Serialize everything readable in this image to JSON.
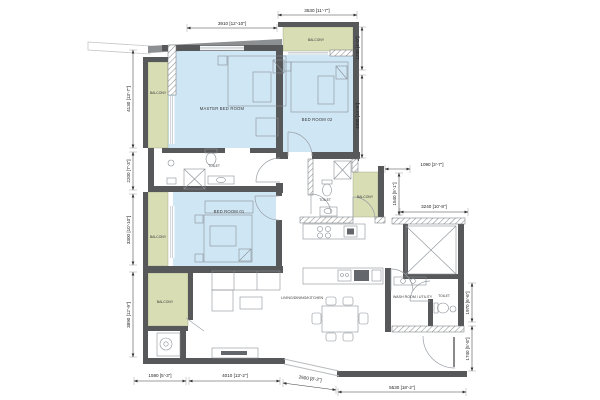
{
  "plan_type": "apartment-floor-plan",
  "labels": {
    "master_bedroom": "MASTER BED ROOM",
    "bed_room_02": "BED ROOM 02",
    "bed_room_01": "BED ROOM 01",
    "living": "LIVING/DINING/KITCHEN",
    "wash_room": "WASH ROOM / UTILITY",
    "toilet": "TOILET",
    "balcony": "BALCONY"
  },
  "dims": {
    "d3910": "3910 [12'-10\"]",
    "d3530": "3530 [11'-7\"]",
    "d1230": "1230 [4'-0\"]",
    "d4490": "4490 [14'-9\"]",
    "d1090": "1090 [3'-7\"]",
    "d1540": "1540 [5'-1\"]",
    "d3240": "3240 [10'-8\"]",
    "d1970": "1970 [6'-6\"]",
    "d1740": "1740 [5'-8\"]",
    "d4130": "4130 [13'-7\"]",
    "d2200": "2200 [7'-3\"]",
    "d3300": "3300 [10'-10\"]",
    "d3890": "3890 [12'-9\"]",
    "d1590": "1590 [5'-3\"]",
    "d4010": "4010 [13'-2\"]",
    "d2500": "2500 [8'-2\"]",
    "d5530": "5530 [18'-2\"]"
  },
  "colors": {
    "bedroom_fill": "#cfe6f4",
    "balcony_fill": "#d9ddb4",
    "wall": "#57585a",
    "dimension_text": "#222222"
  }
}
